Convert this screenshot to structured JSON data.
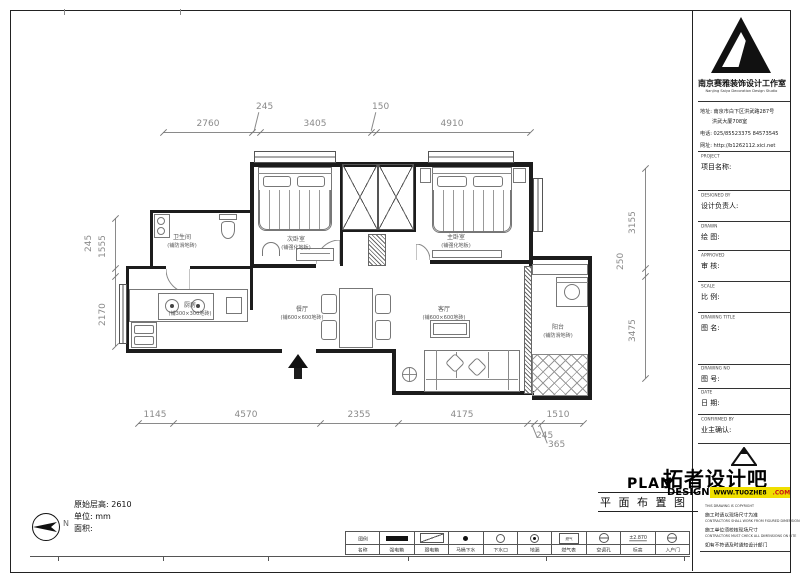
{
  "colors": {
    "accent_yellow": "#f0df00",
    "brand_red": "#c81414",
    "wall": "#1c1c1c",
    "dim_text": "#8a8a8a"
  },
  "company": {
    "name_cn": "南京赛雅装饰设计工作室",
    "name_en": "Nanjing Saiya Decoration Design Studio",
    "address_line1": "地址: 南京市白下区洪武路287号",
    "address_line2": "洪武大厦708室",
    "phone": "电话: 025/85523375  84573545",
    "website": "网址: http://b1262112.xici.net"
  },
  "title_block": {
    "fields": [
      {
        "en": "PROJECT",
        "cn": "项目名称:"
      },
      {
        "en": "DESIGNED BY",
        "cn": "设计负责人:"
      },
      {
        "en": "DRAWN",
        "cn": "绘 图:"
      },
      {
        "en": "APPROVED",
        "cn": "审 核:"
      },
      {
        "en": "SCALE",
        "cn": "比 例:"
      },
      {
        "en": "DRAWING TITLE",
        "cn": "图 名:"
      },
      {
        "en": "DRAWING NO",
        "cn": "图 号:"
      },
      {
        "en": "DATE",
        "cn": "日 期:"
      },
      {
        "en": "CONFIRMED BY",
        "cn": "业主确认:"
      }
    ]
  },
  "tuozhe": {
    "plan": "PLAN",
    "design": "DESIGN",
    "brand": "拓者设计吧",
    "url_main": "WWW.TUOZHE8",
    "url_tld": ".COM"
  },
  "drawing_title": "平 面 布 置 图",
  "copyright_lines": [
    "THIS DRAWING IS COPYRIGHT",
    "施工时请以现场尺寸为准",
    "CONTRACTORS SHALL WORK FROM FIGURED DIMENSIONS ONLY",
    "施工单位须校核现场尺寸",
    "CONTRACTORS MUST CHECK ALL DIMENSIONS ON SITE",
    "如有不符请及时通知设计部门"
  ],
  "legend": [
    {
      "symbol_text": "图例",
      "label": "名称"
    },
    {
      "symbol_text": "",
      "label": "强电箱"
    },
    {
      "symbol_text": "",
      "label": "弱电箱"
    },
    {
      "symbol_text": "",
      "label": "马桶下水"
    },
    {
      "symbol_text": "",
      "label": "下水口"
    },
    {
      "symbol_text": "",
      "label": "地漏"
    },
    {
      "symbol_text": "燃气",
      "label": "燃气表"
    },
    {
      "symbol_text": "",
      "label": "空调孔"
    },
    {
      "symbol_text": "±2.870",
      "label": "标高"
    },
    {
      "symbol_text": "",
      "label": "入户门"
    }
  ],
  "dims": {
    "top": [
      "2760",
      "245",
      "3405",
      "150",
      "4910"
    ],
    "bottom": [
      "1145",
      "4570",
      "2355",
      "4175",
      "1510"
    ],
    "bottom_small": [
      "245",
      "365"
    ],
    "left": [
      "1555",
      "245",
      "2170"
    ],
    "right": [
      "3155",
      "250",
      "3475"
    ]
  },
  "rooms": [
    {
      "name": "卫生间",
      "note": "(铺防滑地砖)"
    },
    {
      "name": "次卧室",
      "note": "(铺强化地板)"
    },
    {
      "name": "主卧室",
      "note": "(铺强化地板)"
    },
    {
      "name": "厨房",
      "note": "(铺300×300地砖)"
    },
    {
      "name": "餐厅",
      "note": "(铺600×600地砖)"
    },
    {
      "name": "客厅",
      "note": "(铺600×600地砖)"
    },
    {
      "name": "阳台",
      "note": "(铺防滑地砖)"
    }
  ],
  "north_label": "N",
  "info": {
    "height": "原始层高: 2610",
    "unit": "单位: mm",
    "area": "面积:"
  }
}
